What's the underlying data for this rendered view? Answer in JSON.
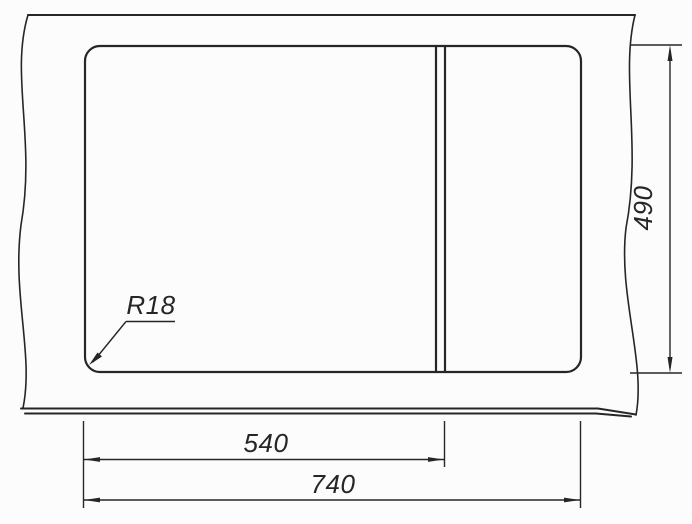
{
  "labels": {
    "corner_radius": "R18",
    "left_section_width": "540",
    "overall_width": "740",
    "overall_depth": "490"
  },
  "colors": {
    "line": "#262626",
    "background": "#fcfcfc"
  }
}
